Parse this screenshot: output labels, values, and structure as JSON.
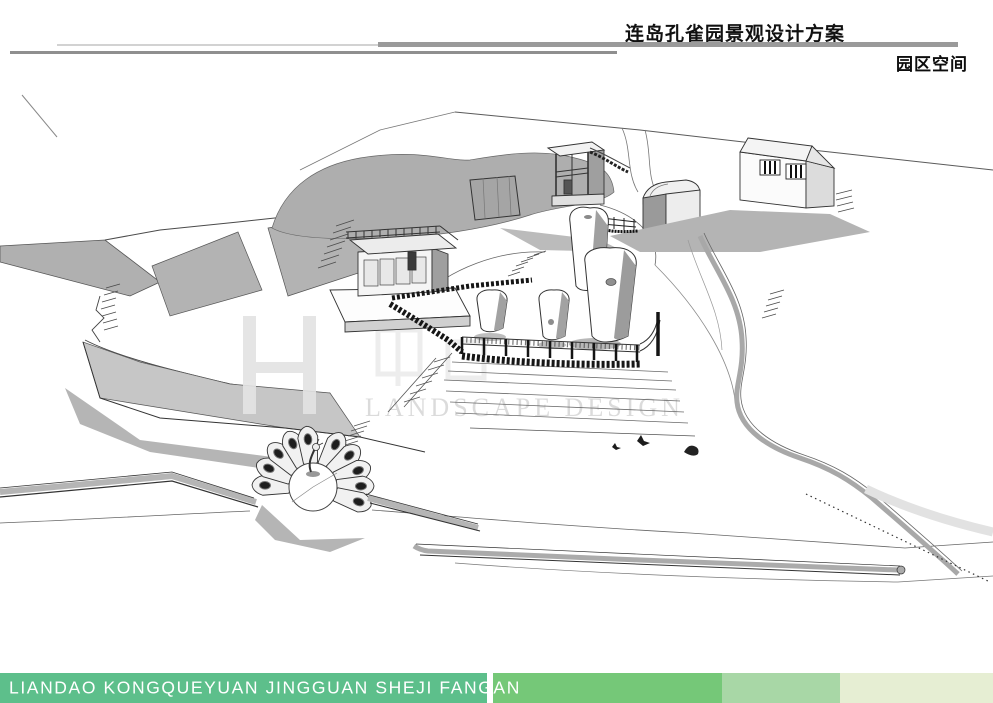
{
  "header": {
    "title": "连岛孔雀园景观设计方案",
    "section_label": "园区空间",
    "rule_colors": {
      "main_bar": "#9a9a9a",
      "thin_line": "#d2d2d2",
      "lower_line": "#8f8f8f"
    }
  },
  "watermark": {
    "text": "LANDSCAPE DESIGN"
  },
  "footer": {
    "caption": "LIANDAO KONGQUEYUAN JINGGUAN SHEJI FANGAN",
    "text_color": "#ffffff",
    "segment_colors": [
      "#5dbf8b",
      "#75c878",
      "#a8d7a6",
      "#e6eed3"
    ]
  }
}
